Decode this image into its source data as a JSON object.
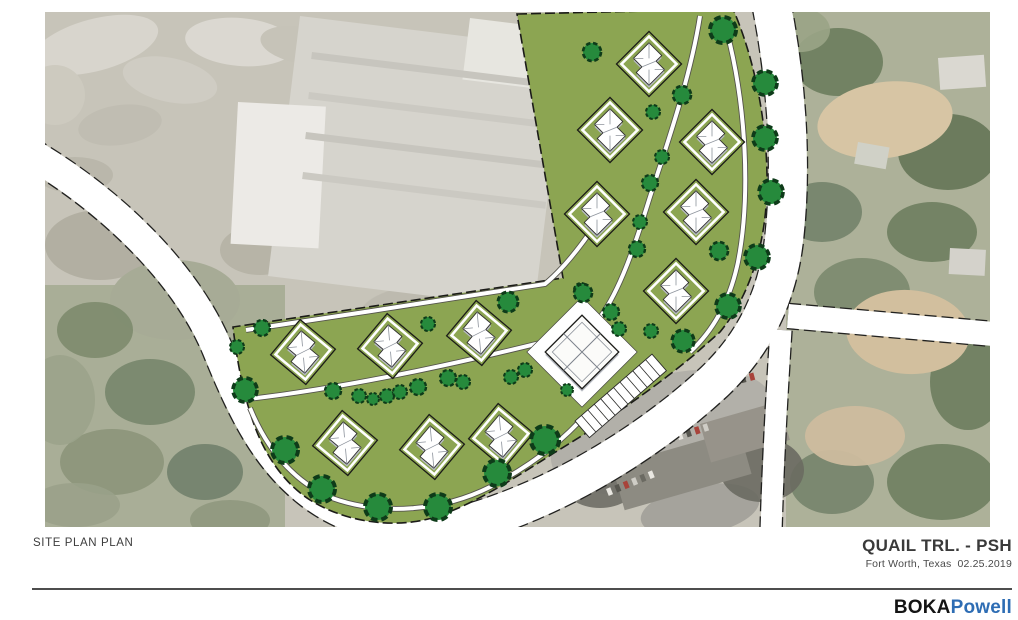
{
  "titleBlock": {
    "drawing_label": "SITE PLAN PLAN",
    "project_name": "QUAIL TRL. - PSH",
    "project_location": "Fort Worth, Texas",
    "project_date": "02.25.2019",
    "logo_primary": "BOKA",
    "logo_secondary": "Powell",
    "logo_secondary_color": "#2e6db4",
    "rule_color": "#4d4d4d"
  },
  "map": {
    "frame": {
      "x": 45,
      "y": 12,
      "w": 945,
      "h": 515
    },
    "colors": {
      "aerial_base": "#c7c4b9",
      "parcel": "#8ca552",
      "parcel_outline": "#1b1b18",
      "road_fill": "#ffffff",
      "road_casing": "#21211f",
      "path_fill": "#ffffff",
      "path_casing": "#55544c",
      "tree_fill": "#268a3c",
      "tree_outline": "#0e3b19",
      "house_fill": "#ffffff",
      "house_shadow": "#b8bcc3",
      "house_outline": "#30302e",
      "house_line": "#8d939c",
      "building_fill": "#fbfbf9",
      "apron_fill": "#ffffff",
      "stall_line": "#2a2a28"
    },
    "aerial": {
      "regions": [
        [
          45,
          285,
          240,
          242,
          "#a9ae97"
        ],
        [
          786,
          12,
          204,
          515,
          "#adb199"
        ]
      ],
      "soft_blobs": [
        [
          95,
          45,
          65,
          26,
          -15,
          "#d8d5cd",
          1
        ],
        [
          170,
          80,
          48,
          22,
          12,
          "#cfccc3",
          1
        ],
        [
          240,
          42,
          55,
          24,
          5,
          "#dbd8d1",
          1
        ],
        [
          120,
          125,
          42,
          20,
          -8,
          "#c0bdb2",
          1
        ],
        [
          75,
          175,
          38,
          18,
          0,
          "#bab7ab",
          1
        ],
        [
          55,
          95,
          30,
          30,
          0,
          "#cdcabf",
          1
        ],
        [
          300,
          45,
          40,
          18,
          10,
          "#c6c3b8",
          1
        ],
        [
          100,
          245,
          55,
          35,
          0,
          "#b2afa2",
          1
        ],
        [
          260,
          250,
          40,
          25,
          0,
          "#b7b4a7",
          1
        ],
        [
          175,
          300,
          65,
          40,
          0,
          "#a7ab96",
          1
        ],
        [
          95,
          330,
          38,
          28,
          0,
          "#7d8b6d",
          0.9
        ],
        [
          150,
          392,
          45,
          33,
          0,
          "#77866b",
          0.9
        ],
        [
          112,
          462,
          52,
          33,
          0,
          "#8c957a",
          0.9
        ],
        [
          205,
          472,
          38,
          28,
          0,
          "#71816b",
          0.9
        ],
        [
          75,
          505,
          45,
          22,
          0,
          "#9aa189",
          0.9
        ],
        [
          230,
          520,
          40,
          20,
          0,
          "#8f987e",
          0.9
        ],
        [
          60,
          400,
          35,
          45,
          0,
          "#9ba38b",
          0.9
        ],
        [
          420,
          310,
          60,
          25,
          -5,
          "#bdbaaf",
          1
        ],
        [
          838,
          62,
          45,
          34,
          0,
          "#6f7f60",
          0.95
        ],
        [
          948,
          152,
          50,
          38,
          0,
          "#68785a",
          0.95
        ],
        [
          822,
          212,
          40,
          30,
          0,
          "#73836a",
          0.9
        ],
        [
          932,
          232,
          45,
          30,
          0,
          "#6e7e5f",
          0.9
        ],
        [
          862,
          292,
          48,
          34,
          0,
          "#7b8a6e",
          0.9
        ],
        [
          968,
          382,
          38,
          48,
          0,
          "#6d7d5e",
          0.9
        ],
        [
          832,
          482,
          42,
          32,
          0,
          "#75846b",
          0.9
        ],
        [
          942,
          482,
          55,
          38,
          0,
          "#6f7f60",
          0.9
        ],
        [
          885,
          120,
          68,
          38,
          -8,
          "#d7c5a4",
          1
        ],
        [
          908,
          332,
          62,
          42,
          4,
          "#d2bf9e",
          1
        ],
        [
          855,
          436,
          50,
          30,
          0,
          "#cdbc9e",
          0.95
        ],
        [
          800,
          30,
          30,
          22,
          0,
          "#9aa486",
          0.9
        ],
        [
          662,
          432,
          115,
          55,
          -17,
          "#b2b0a9",
          1
        ],
        [
          700,
          510,
          60,
          25,
          -10,
          "#a5a39c",
          1
        ],
        [
          600,
          482,
          38,
          26,
          0,
          "#6e6e66",
          0.9
        ],
        [
          762,
          470,
          42,
          32,
          0,
          "#6a6a62",
          0.9
        ]
      ],
      "sharp_rects": [
        [
          300,
          16,
          268,
          262,
          7,
          "#d6d4cd"
        ],
        [
          470,
          18,
          98,
          62,
          7,
          "#e7e6e0"
        ],
        [
          238,
          102,
          88,
          142,
          3,
          "#eceae6"
        ],
        [
          312,
          52,
          245,
          7,
          7,
          "#c7c5be"
        ],
        [
          309,
          92,
          245,
          7,
          7,
          "#cbc9c2"
        ],
        [
          306,
          132,
          245,
          7,
          7,
          "#c7c5be"
        ],
        [
          303,
          172,
          245,
          7,
          7,
          "#cbc9c2"
        ],
        [
          938,
          58,
          46,
          32,
          -4,
          "#dad8d1"
        ],
        [
          858,
          142,
          32,
          22,
          10,
          "#d0d1c7"
        ],
        [
          950,
          248,
          36,
          26,
          3,
          "#d4d2cb"
        ],
        [
          612,
          466,
          132,
          46,
          -16,
          "#8d8b82"
        ],
        [
          700,
          424,
          82,
          40,
          -16,
          "#97938a"
        ]
      ],
      "car_rows": [
        [
          688,
          390,
          -15,
          8,
          9
        ],
        [
          634,
          447,
          -18,
          9,
          9
        ],
        [
          606,
          489,
          -22,
          6,
          9
        ]
      ],
      "car_colors": [
        "#e9e7e1",
        "#57564f",
        "#a8433a",
        "#cfcdc6",
        "#6b6a62"
      ]
    },
    "roads": [
      {
        "name": "west-loop-road",
        "d": "M 28,152 C 110,200 185,272 217,348 C 243,412 267,462 315,497 C 352,523 400,534 450,536",
        "width": 30
      },
      {
        "name": "quail-trail-road",
        "d": "M 768,-12 C 786,70 793,160 784,240 C 777,298 754,344 714,382 C 660,432 592,476 524,504 C 486,520 452,529 428,532",
        "width": 38
      },
      {
        "name": "east-branch-road",
        "d": "M 788,316 L 994,334",
        "width": 24
      },
      {
        "name": "south-branch-road",
        "d": "M 781,330 C 777,392 773,462 771,532",
        "width": 21
      }
    ],
    "parcel": {
      "d": "M 517,14 L 733,9 C 753,55 766,115 767,175 C 768,235 753,292 720,332 L 694,355 C 652,390 602,424 554,453 C 516,477 474,505 432,518 C 393,529 345,522 310,500 C 282,482 261,450 250,412 C 242,388 236,354 233,327 L 563,278 Z"
    },
    "walkways": [
      "M 700,16 C 690,80 665,150 649,200 C 636,242 621,288 601,316",
      "M 727,32 C 746,105 751,195 738,262 C 730,300 714,330 690,352",
      "M 240,400 C 330,390 440,368 552,340",
      "M 250,408 C 268,452 296,483 332,498 C 382,516 442,511 490,487 C 530,466 558,444 578,423",
      "M 246,330 C 340,316 470,296 545,284 C 562,270 577,251 591,231"
    ],
    "houses": [
      [
        649,
        64,
        45
      ],
      [
        610,
        130,
        45
      ],
      [
        712,
        142,
        45
      ],
      [
        597,
        214,
        45
      ],
      [
        696,
        212,
        45
      ],
      [
        676,
        291,
        45
      ],
      [
        303,
        352,
        40
      ],
      [
        390,
        346,
        40
      ],
      [
        479,
        333,
        40
      ],
      [
        345,
        443,
        40
      ],
      [
        432,
        447,
        40
      ],
      [
        501,
        436,
        40
      ]
    ],
    "building": {
      "x": 582,
      "y": 352,
      "half": 26,
      "apron_half": 39
    },
    "parking": {
      "x": 575,
      "y": 421,
      "angle": -41,
      "length": 102,
      "width": 22,
      "stalls": 12
    },
    "trees": [
      [
        592,
        52,
        9
      ],
      [
        723,
        30,
        13
      ],
      [
        765,
        83,
        12
      ],
      [
        682,
        95,
        9
      ],
      [
        653,
        112,
        7
      ],
      [
        765,
        138,
        12
      ],
      [
        662,
        157,
        7
      ],
      [
        650,
        183,
        8
      ],
      [
        771,
        192,
        12
      ],
      [
        640,
        222,
        7
      ],
      [
        637,
        249,
        8
      ],
      [
        719,
        251,
        9
      ],
      [
        757,
        257,
        12
      ],
      [
        581,
        290,
        7
      ],
      [
        611,
        312,
        8
      ],
      [
        728,
        306,
        12
      ],
      [
        619,
        329,
        7
      ],
      [
        651,
        331,
        7
      ],
      [
        683,
        341,
        11
      ],
      [
        508,
        302,
        10
      ],
      [
        583,
        293,
        9
      ],
      [
        525,
        370,
        7
      ],
      [
        511,
        377,
        7
      ],
      [
        567,
        390,
        6
      ],
      [
        545,
        440,
        14
      ],
      [
        245,
        390,
        12
      ],
      [
        262,
        328,
        8
      ],
      [
        237,
        347,
        7
      ],
      [
        285,
        450,
        13
      ],
      [
        322,
        489,
        13
      ],
      [
        378,
        507,
        13
      ],
      [
        438,
        507,
        13
      ],
      [
        497,
        473,
        13
      ],
      [
        333,
        391,
        8
      ],
      [
        359,
        396,
        7
      ],
      [
        373,
        399,
        6
      ],
      [
        387,
        396,
        7
      ],
      [
        400,
        392,
        7
      ],
      [
        418,
        387,
        8
      ],
      [
        448,
        378,
        8
      ],
      [
        463,
        382,
        7
      ],
      [
        428,
        324,
        7
      ]
    ]
  }
}
